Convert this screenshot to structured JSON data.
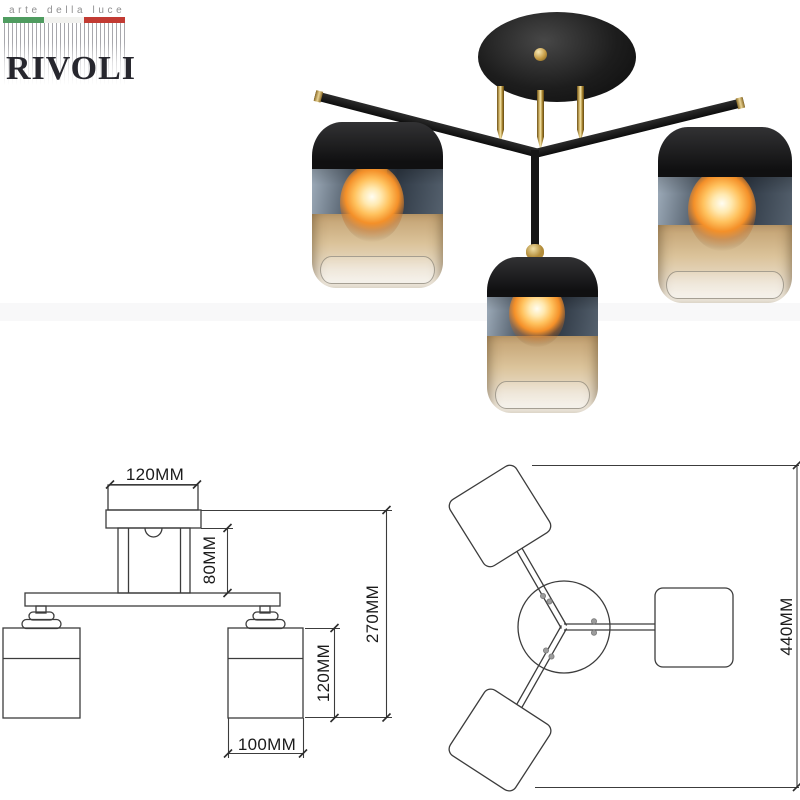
{
  "brand": {
    "tagline": "arte della luce",
    "name": "RIVOLI",
    "flag_colors": [
      "#4f9c60",
      "#f2f2ef",
      "#c23b33"
    ]
  },
  "dimensions": {
    "front_view": {
      "canopy_width": "120MM",
      "stem_height": "80MM",
      "total_height": "270MM",
      "shade_height": "120MM",
      "shade_width": "100MM"
    },
    "top_view": {
      "overall_diameter": "440MM"
    }
  },
  "colors": {
    "fixture_black": "#1a1a1a",
    "fixture_gold": "#c7a35c",
    "smoked_glass": "#3c4652",
    "amber_glass": "#d9c49c",
    "drawing_line": "#3c3c3c"
  }
}
